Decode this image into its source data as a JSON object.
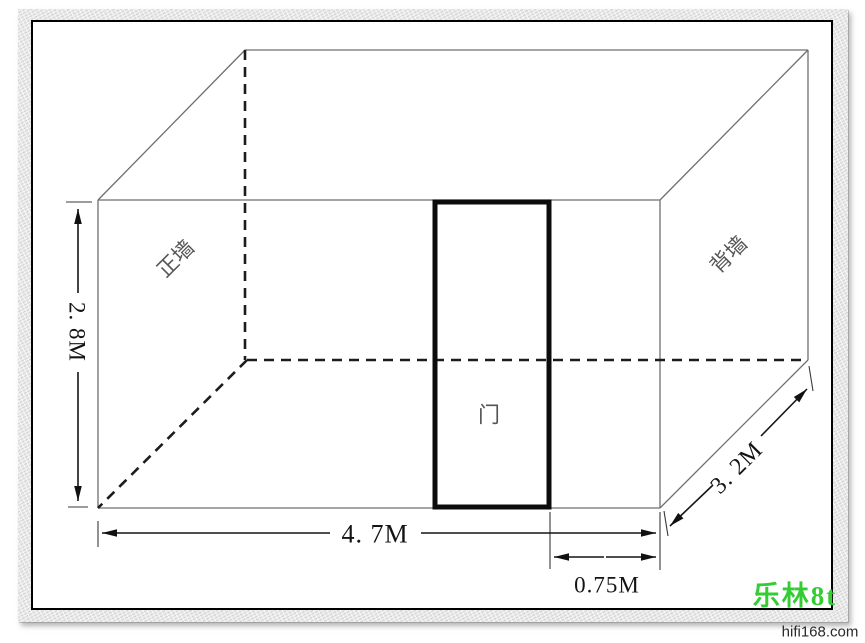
{
  "room": {
    "front_wall_label": "正墙",
    "back_wall_label": "背墙",
    "door_label": "门"
  },
  "dimensions": {
    "height": "2. 8M",
    "width": "4. 7M",
    "depth": "3. 2M",
    "door_offset": "0.75M"
  },
  "watermark": {
    "name": "乐林8t",
    "site": "hifi168.com",
    "color": "#33cc33"
  }
}
